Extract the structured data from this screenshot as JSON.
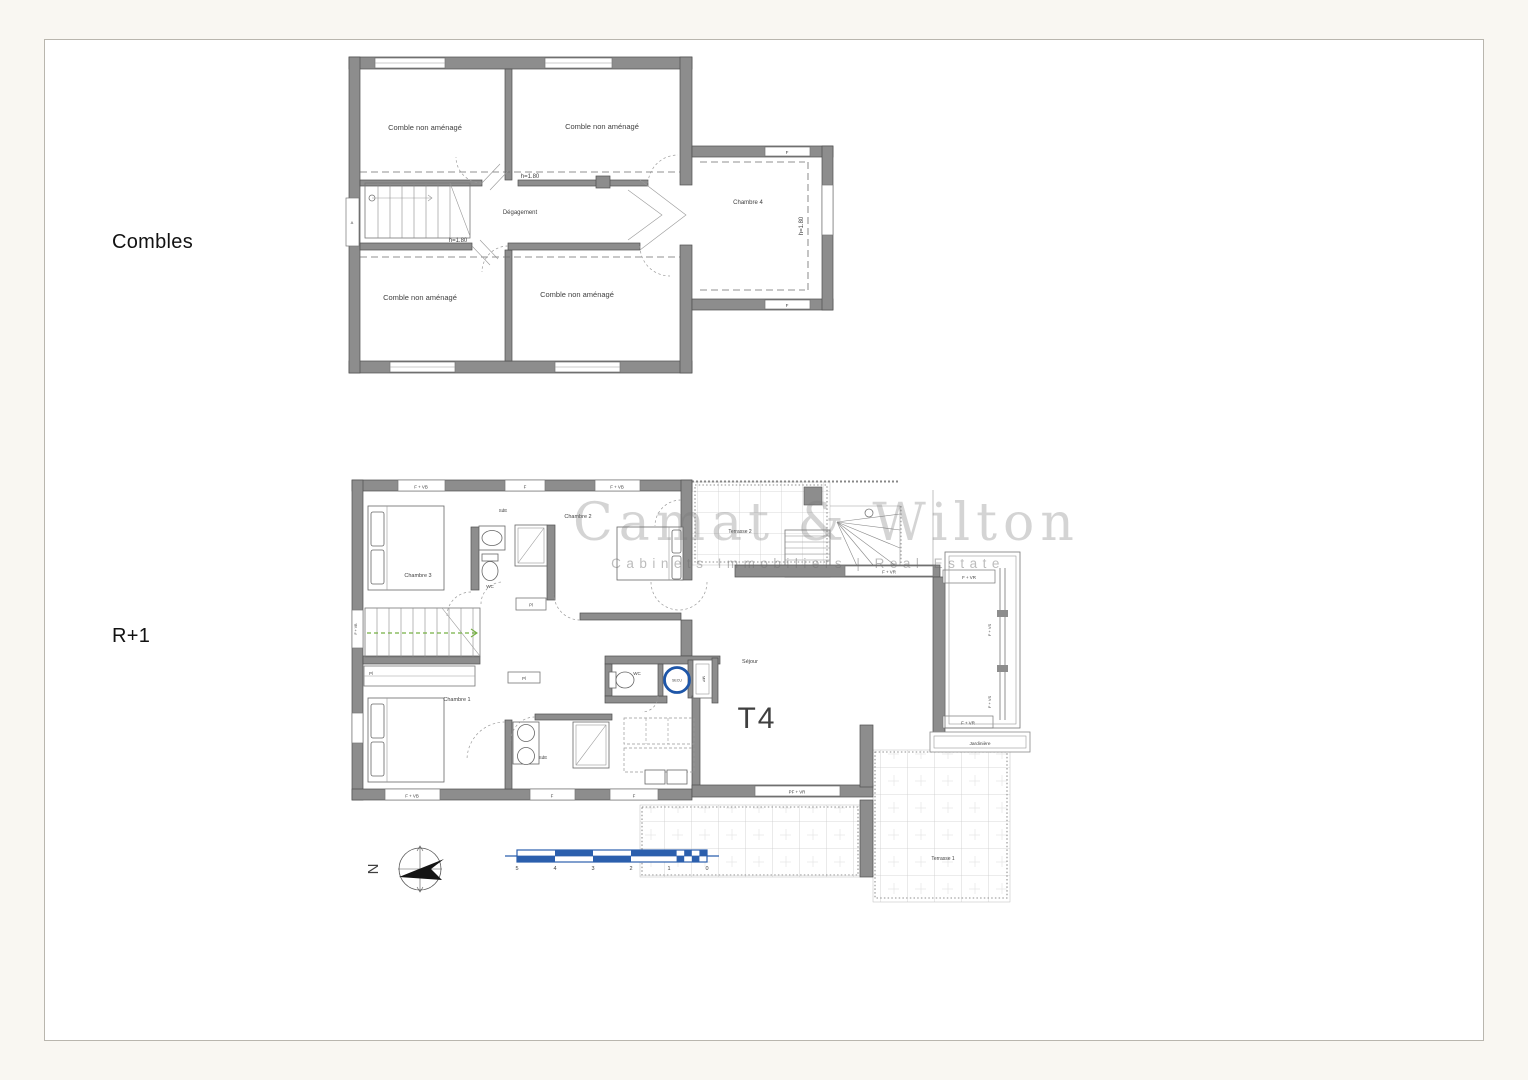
{
  "page": {
    "combles_label": "Combles",
    "r1_label": "R+1"
  },
  "watermark": {
    "brand": "Camat & Wilton",
    "tagline": "Cabinets Immobiliers | Real Estate"
  },
  "combles": {
    "comble_room": "Comble non aménagé",
    "hall": "Dégagement",
    "chambre4": "Chambre 4",
    "h180": "h=1.80",
    "win_f": "F",
    "win_a": "A"
  },
  "r1": {
    "type_label": "T4",
    "sejour": "Séjour",
    "chambre1": "Chambre 1",
    "chambre2": "Chambre 2",
    "chambre3": "Chambre 3",
    "sde": "SdE",
    "wc": "WC",
    "pl": "Pl",
    "terrasse1": "Terrasse 1",
    "terrasse2": "Terrasse 2",
    "jardiniere": "Jardinière",
    "secu_tag": "SECU",
    "mp_closet": "MP",
    "win_f_vb": "F + VB",
    "win_f": "F",
    "win_f_vr": "F + VR",
    "win_f_vs": "F + VS",
    "win_pf_vr": "PF + VR"
  },
  "compass": {
    "north": "N"
  },
  "scale_bar": {
    "ticks": [
      "5",
      "4",
      "3",
      "2",
      "1",
      "0"
    ]
  }
}
